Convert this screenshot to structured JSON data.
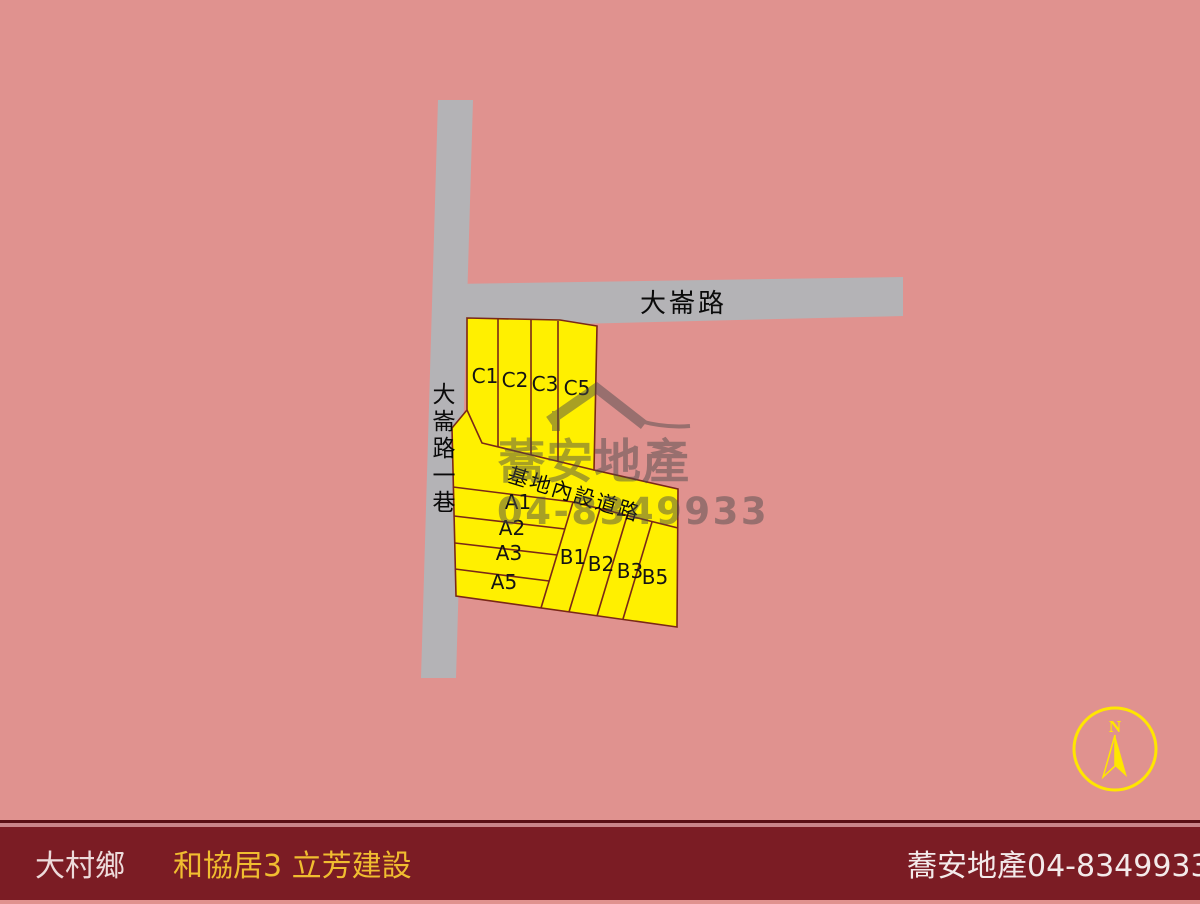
{
  "slide": {
    "background_color": "#e0928f"
  },
  "map": {
    "road_color": "#b4b3b6",
    "plot_fill": "#fff000",
    "plot_stroke": "#7a2817",
    "label_color": "#141414",
    "road_labels": {
      "main_road": "大崙路",
      "side_lane": "大崙路一巷",
      "internal_road": "基地內設道路"
    },
    "plots": [
      {
        "label": "C1"
      },
      {
        "label": "C2"
      },
      {
        "label": "C3"
      },
      {
        "label": "C5"
      },
      {
        "label": "A1"
      },
      {
        "label": "A2"
      },
      {
        "label": "A3"
      },
      {
        "label": "A5"
      },
      {
        "label": "B1"
      },
      {
        "label": "B2"
      },
      {
        "label": "B3"
      },
      {
        "label": "B5"
      }
    ]
  },
  "watermark": {
    "company": "蕎安地產",
    "phone": "04-8349933",
    "color": "#4b4b4b"
  },
  "compass": {
    "north_label": "N",
    "color": "#ffe600"
  },
  "footer": {
    "bar_color": "#7b1c24",
    "township": "大村鄉",
    "township_color": "#eddbdb",
    "project": "和協居3 立芳建設",
    "project_color": "#f0bd30",
    "agency": "蕎安地產",
    "phone": "04-8349933",
    "agency_color": "#f3eaea"
  }
}
